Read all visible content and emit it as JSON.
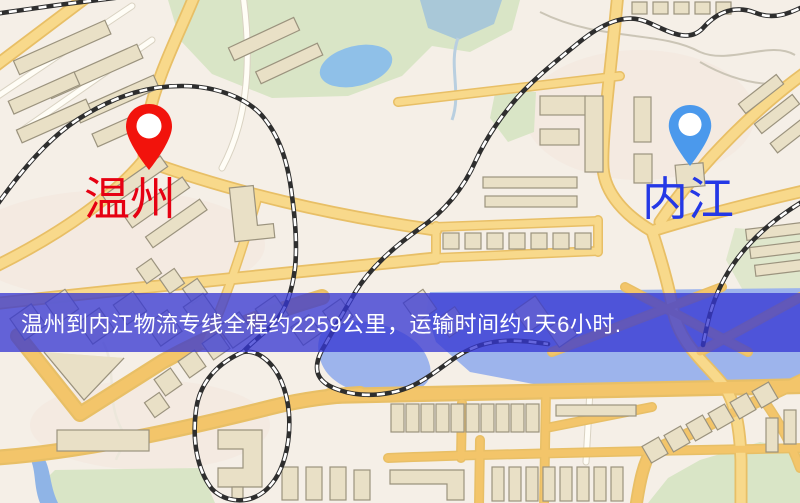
{
  "banner": {
    "text": "温州到内江物流专线全程约2259公里，运输时间约1天6小时.",
    "background_color": "#3436d2",
    "text_color": "#ffffff"
  },
  "markers": {
    "origin": {
      "label": "温州",
      "pin_color": "#f2130c",
      "label_color": "#e60012"
    },
    "destination": {
      "label": "内江",
      "pin_color": "#4b99ec",
      "label_color": "#2438e6"
    }
  },
  "route_info": {
    "origin": "温州",
    "destination": "内江",
    "distance": "约2259公里",
    "duration": "约1天6小时"
  },
  "map_palette": {
    "background": "#f5efe7",
    "road_fill": "#f8d98b",
    "road_casing": "#e8bf66",
    "road_orange": "#f3c56a",
    "water": "#9db4ec",
    "pond": "#8fc0e8",
    "park": "#d9e5c6",
    "building": "#e9e0c6",
    "railway": "#2e2e2e"
  }
}
